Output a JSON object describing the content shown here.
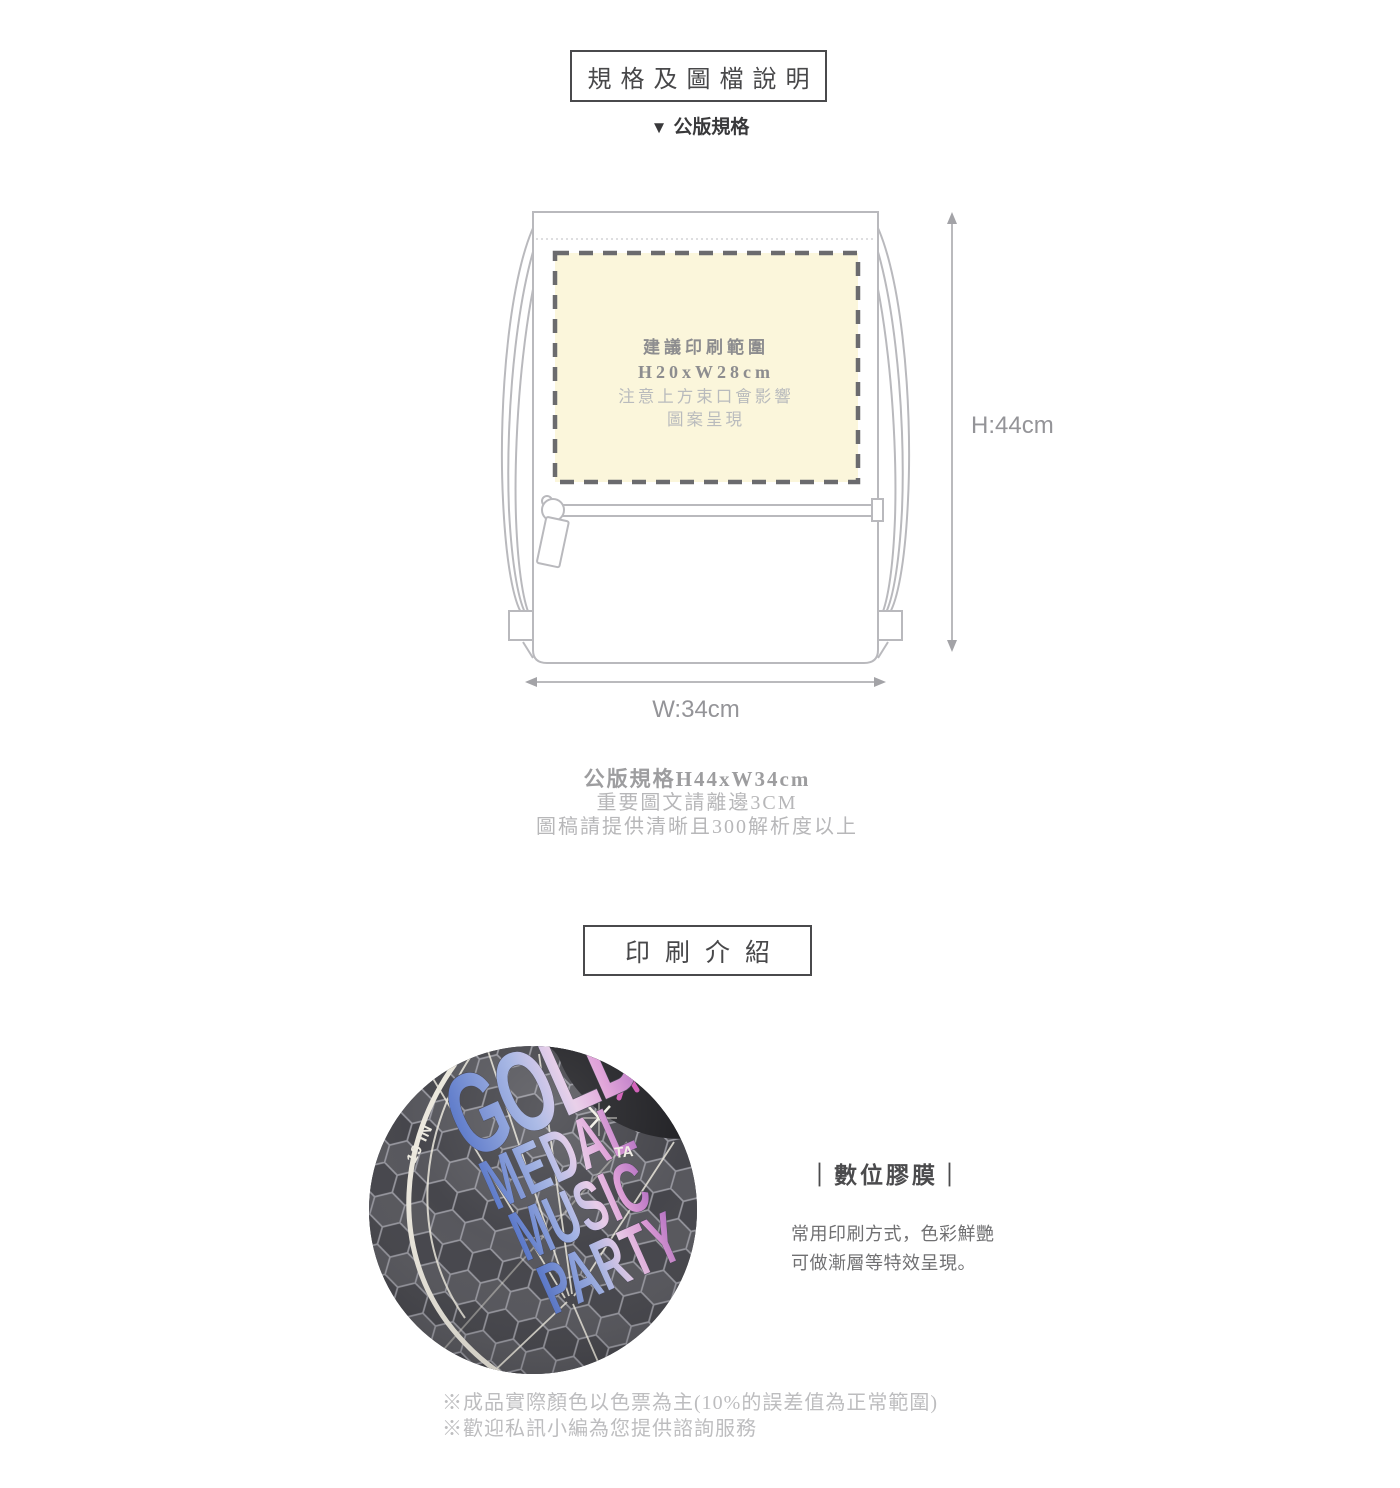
{
  "header": {
    "title": "規格及圖檔說明",
    "subtitle_marker": "▼",
    "subtitle": "公版規格"
  },
  "diagram": {
    "print_area": {
      "line1": "建議印刷範圍",
      "line2": "H20xW28cm",
      "line3": "注意上方束口會影響",
      "line4": "圖案呈現",
      "fill_color": "#FBF6DB"
    },
    "height_label": "H:44cm",
    "width_label": "W:34cm"
  },
  "spec_text": {
    "line1": "公版規格H44xW34cm",
    "line2": "重要圖文請離邊3CM",
    "line3": "圖稿請提供清晰且300解析度以上"
  },
  "print_intro": {
    "title": "印刷介紹",
    "photo": {
      "words": [
        "GOLD",
        "MEDAL",
        "MUSIC",
        "PARTY"
      ],
      "tag_left": "19 IN",
      "tag_right": "TA",
      "gradient_start": "#4f6fc5",
      "gradient_end": "#b26cc0"
    },
    "method": {
      "name": "｜數位膠膜｜",
      "desc_line1": "常用印刷方式，色彩鮮艷",
      "desc_line2": "可做漸層等特效呈現。"
    }
  },
  "footnotes": {
    "note1": "※成品實際顏色以色票為主(10%的誤差值為正常範圍)",
    "note2": "※歡迎私訊小編為您提供諮詢服務"
  }
}
